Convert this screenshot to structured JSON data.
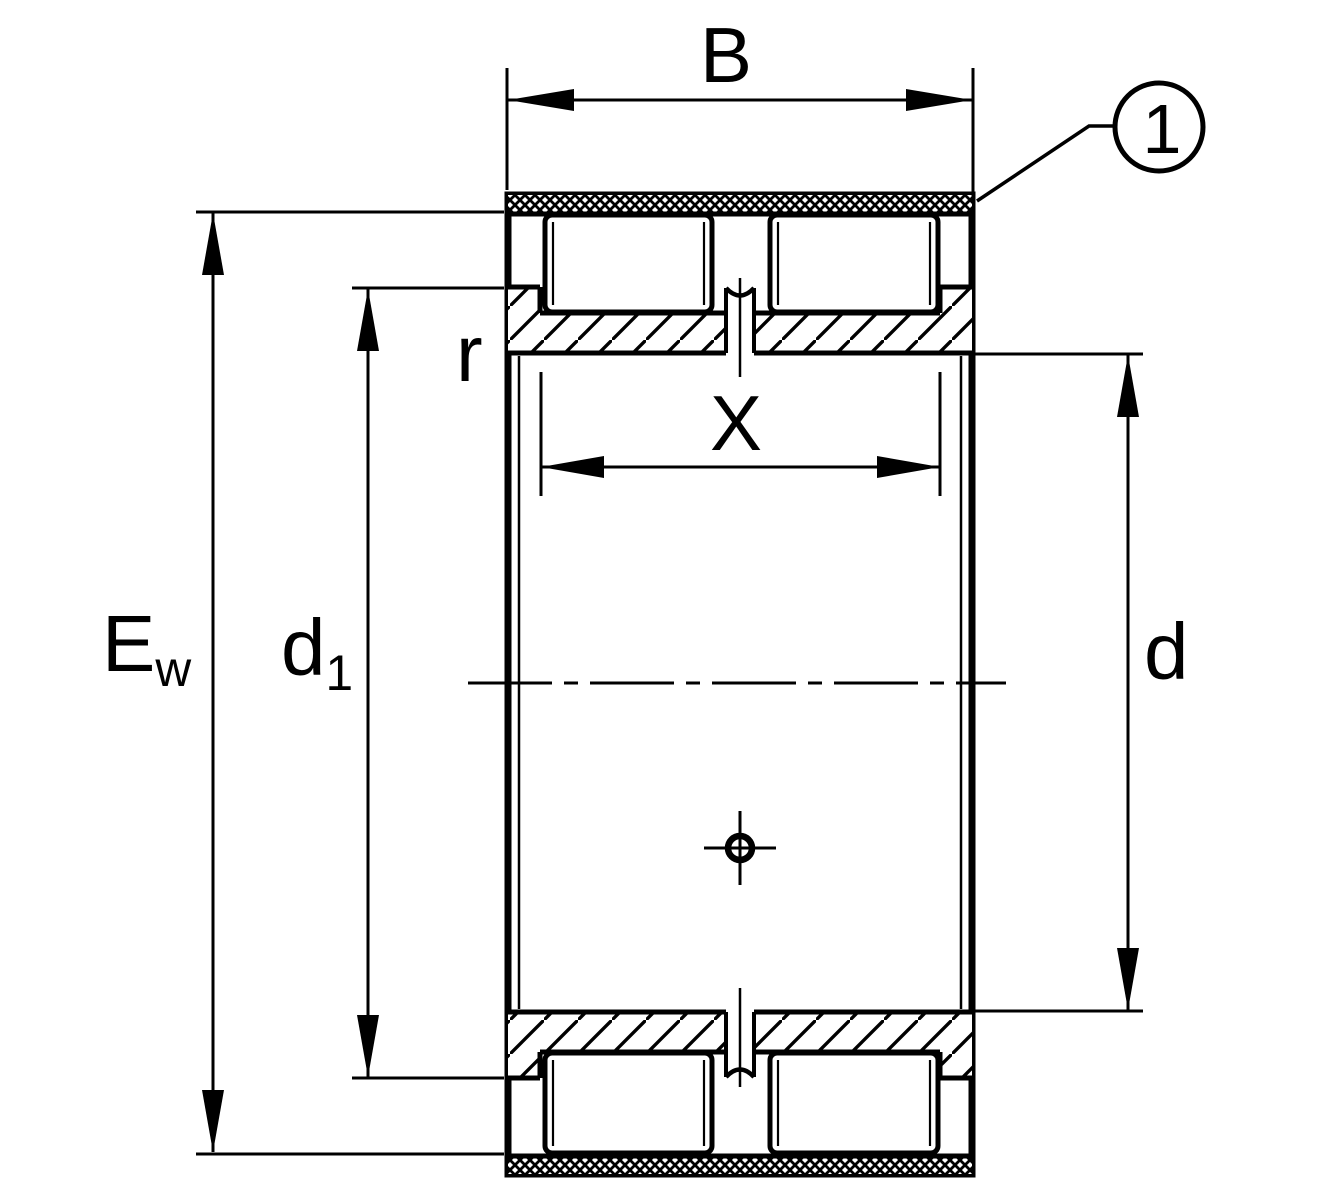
{
  "drawing": {
    "kind": "bearing-cross-section",
    "colors": {
      "line": "#000000",
      "background": "#ffffff"
    },
    "dimensions": {
      "width_label": "B",
      "roller_span_label": "X",
      "raceway_diameter_main": "E",
      "raceway_diameter_sub": "w",
      "shoulder_diameter_main": "d",
      "shoulder_diameter_sub": "1",
      "bore_diameter_label": "d",
      "chamfer_label": "r"
    },
    "callout": {
      "number": "1"
    }
  }
}
